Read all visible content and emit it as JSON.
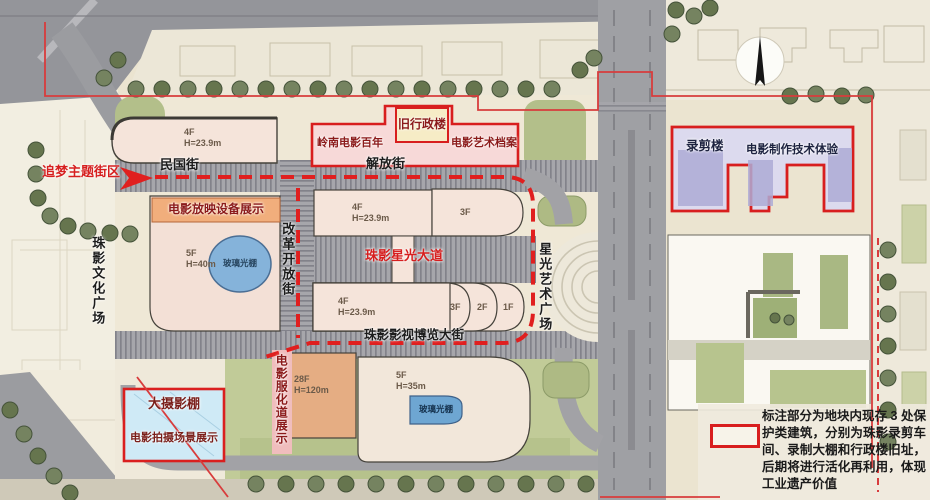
{
  "map": {
    "districts": {
      "theme_district": "追梦主题街区",
      "culture_plaza": "珠影文化广场",
      "starlight_plaza": "星光艺术广场"
    },
    "streets": {
      "minguo": "民国街",
      "jiefang": "解放街",
      "reform": "改革开放街",
      "star_avenue": "珠影星光大道",
      "expo": "珠影影视博览大街"
    },
    "venues": {
      "projection_expo": "电影放映设备展示",
      "costume_expo": "电影服化道展示",
      "lingnan_century": "岭南电影百年",
      "old_admin": "旧行政楼",
      "art_archive": "电影艺术档案",
      "recording_building": "录剪楼",
      "film_tech": "电影制作技术体验",
      "big_studio": "大摄影棚",
      "shooting_scene": "电影拍摄场景展示",
      "glass_shed_round": "玻璃光棚",
      "glass_shed_small": "玻璃光棚"
    },
    "buildings": {
      "top_left": {
        "floors": "4F",
        "height": "H=23.9m"
      },
      "mid_upper": {
        "floors": "4F",
        "height": "H=23.9m"
      },
      "mid_upper_3f": {
        "floors": "3F"
      },
      "mid_lower": {
        "floors": "4F",
        "height": "H=23.9m"
      },
      "arc_3f": {
        "floors": "3F"
      },
      "arc_2f": {
        "floors": "2F"
      },
      "arc_1f": {
        "floors": "1F"
      },
      "left_glass": {
        "floors": "5F",
        "height": "H=40m"
      },
      "tower": {
        "floors": "28F",
        "height": "H=120m"
      },
      "south_hall": {
        "floors": "5F",
        "height": "H=35m"
      }
    },
    "legend": {
      "note": "标注部分为地块内现存 3 处保护类建筑，分别为珠影录剪车间、录制大棚和行政楼旧址，后期将进行活化再利用，体现工业遗产价值"
    },
    "colors": {
      "protected_outline": "#d81e1e",
      "route_dash": "#e01f1f",
      "heritage_pink": "#f7d9d8",
      "heritage_lavender": "#dcdaee",
      "studio_blue": "#cfeaf6"
    }
  }
}
